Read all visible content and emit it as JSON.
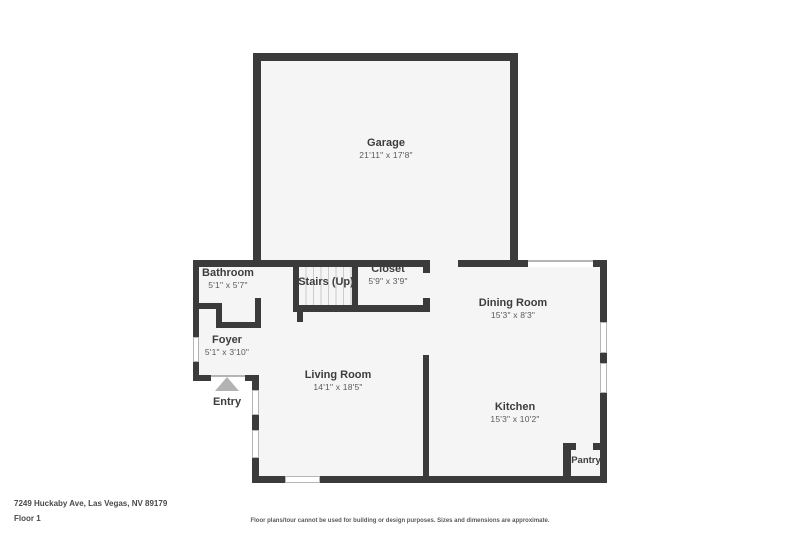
{
  "colors": {
    "wall": "#3b3b3b",
    "floor": "#f5f5f5",
    "background": "#ffffff",
    "label": "#3d3d3d",
    "dim_text": "#5a5a5a",
    "window_line": "#b5b5b5",
    "entry_arrow": "#b3b3b3",
    "stair_tread": "#cccccc"
  },
  "rooms": {
    "garage": {
      "name": "Garage",
      "dims": "21'11\" x 17'8\""
    },
    "bathroom": {
      "name": "Bathroom",
      "dims": "5'1\" x 5'7\""
    },
    "stairs": {
      "name": "Stairs (Up)"
    },
    "closet": {
      "name": "Closet",
      "dims": "5'9\" x 3'9\""
    },
    "dining": {
      "name": "Dining Room",
      "dims": "15'3\" x 8'3\""
    },
    "foyer": {
      "name": "Foyer",
      "dims": "5'1\" x 3'10\""
    },
    "living": {
      "name": "Living Room",
      "dims": "14'1\" x 18'5\""
    },
    "kitchen": {
      "name": "Kitchen",
      "dims": "15'3\" x 10'2\""
    },
    "pantry": {
      "name": "Pantry"
    }
  },
  "entry_label": "Entry",
  "footer": {
    "address": "7249 Huckaby Ave, Las Vegas, NV 89179",
    "floor": "Floor 1",
    "disclaimer": "Floor plans/tour cannot be used for building or design purposes. Sizes and dimensions are approximate."
  }
}
